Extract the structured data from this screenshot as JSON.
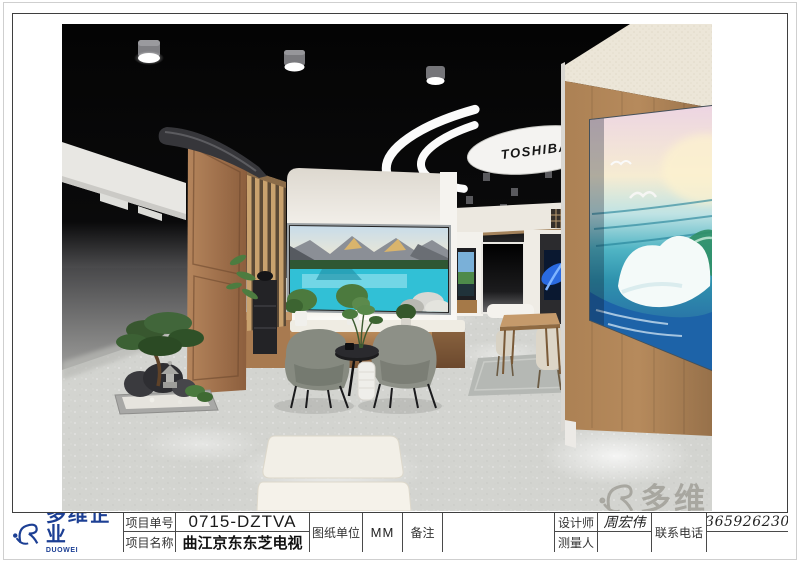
{
  "sheet": {
    "company_logo": {
      "name_cn": "多维企业",
      "name_en": "DUOWEI ENTERPRISE"
    },
    "title_block": {
      "project_no": {
        "label": "项目单号",
        "value": "0715-DZTVA"
      },
      "project_name": {
        "label": "项目名称",
        "value": "曲江京东东芝电视"
      },
      "drawing_unit": {
        "label": "图纸单位",
        "value": "MM"
      },
      "remarks": {
        "label": "备注",
        "value": ""
      },
      "designer": {
        "label": "设计师",
        "value": "周宏伟"
      },
      "surveyor": {
        "label": "测量人",
        "value": ""
      },
      "phone": {
        "label": "联系电话",
        "value": "13659262305"
      }
    }
  },
  "scene": {
    "brand_text": "TOSHIBA",
    "watermark_text": "多维",
    "description": "Toshiba TV showroom interior rendering",
    "colors": {
      "logo_blue": "#1c3f94",
      "ceiling_black": "#050505",
      "wood": "#a87a50",
      "floor_gray": "#d3d4d0",
      "wall_cream": "#f0ede7",
      "lake_teal": "#31c0d6",
      "ocean_blue": "#1d63a8"
    }
  }
}
